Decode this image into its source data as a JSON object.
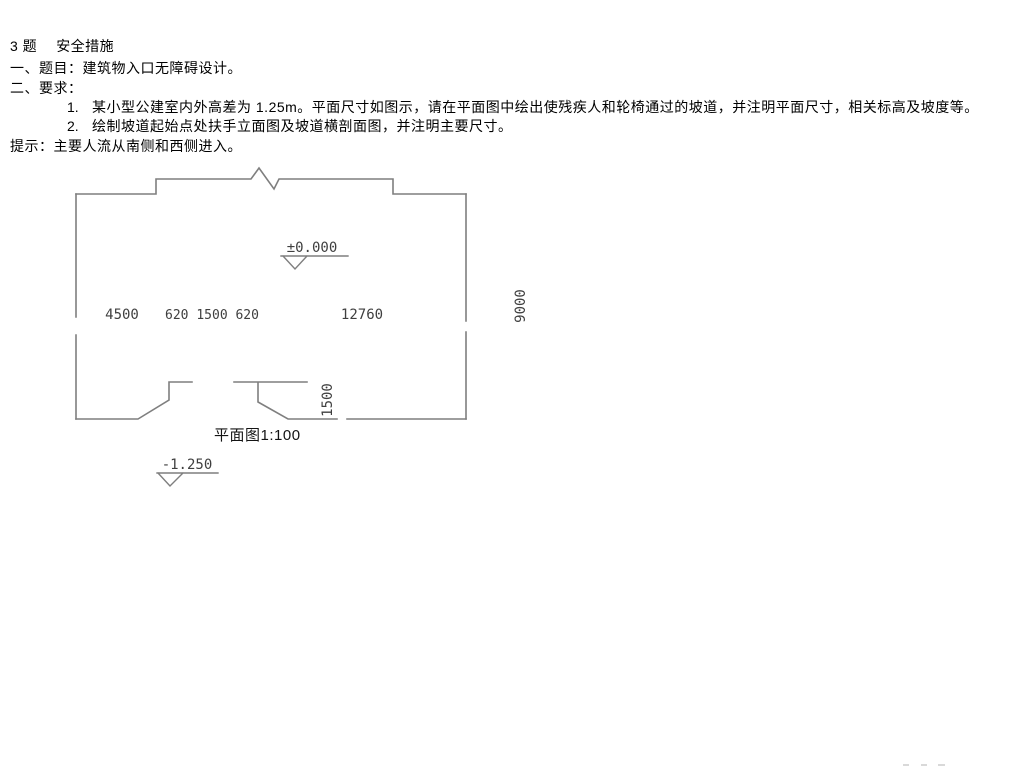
{
  "document": {
    "title_num": "3 题",
    "title_text": "安全措施",
    "subtitle": "一、题目：建筑物入口无障碍设计。",
    "requirements_header": "二、要求：",
    "items": [
      {
        "num": "1.",
        "text": "某小型公建室内外高差为 1.25m。平面尺寸如图示，请在平面图中绘出使残疾人和轮椅通过的坡道，并注明平面尺寸，相关标高及坡度等。"
      },
      {
        "num": "2.",
        "text": "绘制坡道起始点处扶手立面图及坡道横剖面图，并注明主要尺寸。"
      }
    ],
    "hint": "提示：主要人流从南侧和西侧进入。"
  },
  "plan": {
    "label": "平面图1:100",
    "dimensions": {
      "west_width": "4500",
      "entrance_widths": "620 1500 620",
      "east_width": "12760",
      "building_depth": "9000",
      "porch_depth": "1500"
    },
    "levels": {
      "floor": "±0.000",
      "ground": "-1.250"
    },
    "colors": {
      "wall_line": "#7f7f7f",
      "dim_text": "#3f3f3f",
      "body_text": "#000000",
      "watermark": "#d9d9d9"
    }
  }
}
